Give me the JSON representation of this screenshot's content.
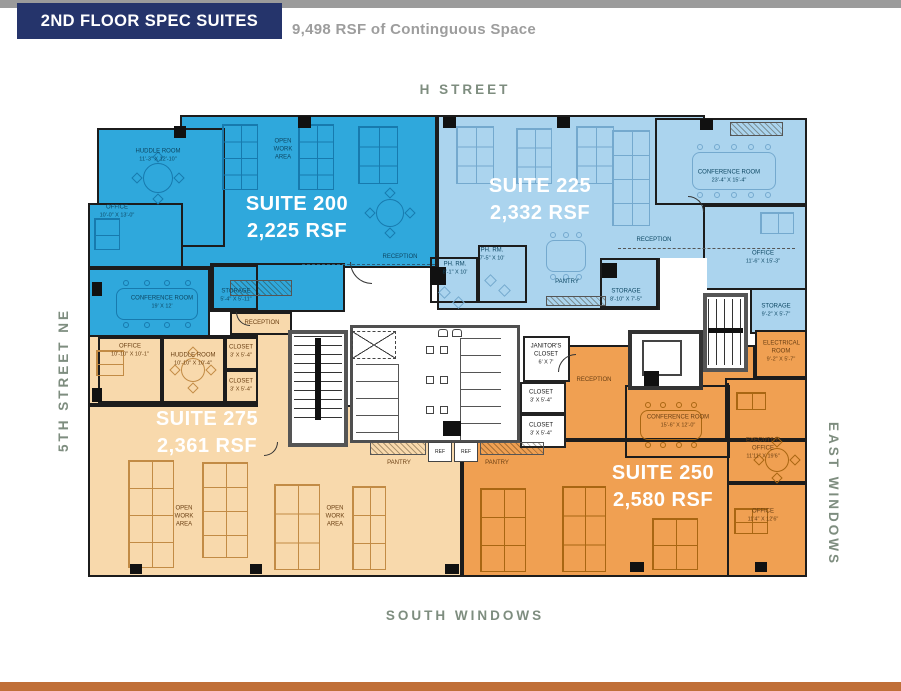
{
  "header": {
    "bar_title": "2ND FLOOR SPEC SUITES",
    "subtitle": "9,498 RSF of Continguous Space"
  },
  "streets": {
    "top": "H STREET",
    "left": "5TH STREET NE",
    "right": "EAST WINDOWS",
    "bottom": "SOUTH WINDOWS"
  },
  "suites": {
    "s200": {
      "name": "SUITE 200",
      "rsf": "2,225 RSF"
    },
    "s225": {
      "name": "SUITE 225",
      "rsf": "2,332 RSF"
    },
    "s275": {
      "name": "SUITE 275",
      "rsf": "2,361 RSF"
    },
    "s250": {
      "name": "SUITE 250",
      "rsf": "2,580 RSF"
    }
  },
  "rooms": {
    "s200_open": {
      "name": "OPEN WORK AREA"
    },
    "s200_huddle": {
      "name": "HUDDLE ROOM",
      "dims": "11'-3\" X 12'-10\""
    },
    "s200_office": {
      "name": "OFFICE",
      "dims": "10'-0\" X 13'-0\""
    },
    "s200_conf": {
      "name": "CONFERENCE ROOM",
      "dims": "19' X 12'"
    },
    "s200_storage": {
      "name": "STORAGE",
      "dims": "5'-4\" X 5'-11\""
    },
    "s200_reception": {
      "name": "RECEPTION"
    },
    "s225_conf": {
      "name": "CONFERENCE ROOM",
      "dims": "23'-4\" X 15'-4\""
    },
    "s225_reception": {
      "name": "RECEPTION"
    },
    "s225_office": {
      "name": "OFFICE",
      "dims": "11'-6\" X 15'-3\""
    },
    "s225_phone1": {
      "name": "PH. RM.",
      "dims": "7'-5\" X 10'"
    },
    "s225_phone2": {
      "name": "PH. RM.",
      "dims": "8'-1\" X 10'"
    },
    "s225_pantry": {
      "name": "PANTRY"
    },
    "s225_storage1": {
      "name": "STORAGE",
      "dims": "8'-10\" X 7'-5\""
    },
    "s225_storage2": {
      "name": "STORAGE",
      "dims": "9'-2\" X 5'-7\""
    },
    "s275_office": {
      "name": "OFFICE",
      "dims": "10'-10\" X 10'-1\""
    },
    "s275_huddle": {
      "name": "HUDDLE ROOM",
      "dims": "10'-10\" X 10'-4\""
    },
    "s275_closet1": {
      "name": "CLOSET",
      "dims": "3' X 5'-4\""
    },
    "s275_closet2": {
      "name": "CLOSET",
      "dims": "3' X 5'-4\""
    },
    "s275_reception": {
      "name": "RECEPTION"
    },
    "s275_open1": {
      "name": "OPEN WORK AREA"
    },
    "s275_open2": {
      "name": "OPEN WORK AREA"
    },
    "s275_pantry": {
      "name": "PANTRY"
    },
    "s250_reception": {
      "name": "RECEPTION"
    },
    "s250_conf": {
      "name": "CONFERENCE ROOM",
      "dims": "15'-6\" X 12'-0\""
    },
    "s250_exec": {
      "name": "EXECUTIVE OFFICE",
      "dims": "11'11\" X 19'6\""
    },
    "s250_office": {
      "name": "OFFICE",
      "dims": "11'4\" X 12'6\""
    },
    "s250_electrical": {
      "name": "ELECTRICAL ROOM",
      "dims": "9'-2\" X 5'-7\""
    },
    "s250_pantry": {
      "name": "PANTRY"
    },
    "core_janitor": {
      "name": "JANITOR'S CLOSET",
      "dims": "6' X 7'"
    },
    "core_closet1": {
      "name": "CLOSET",
      "dims": "3' X 5'-4\""
    },
    "core_closet2": {
      "name": "CLOSET",
      "dims": "3' X 5'-4\""
    },
    "ref": "REF"
  },
  "colors": {
    "suite200": "#2FA8DC",
    "suite225": "#ABD4EE",
    "suite275": "#F8D9AC",
    "suite250": "#F0A052",
    "navy": "#25346B",
    "top_bar": "#9B9B9B",
    "bottom_bar": "#C06F38",
    "street_text": "#7E8D7F",
    "wall": "#1C1C1C"
  }
}
